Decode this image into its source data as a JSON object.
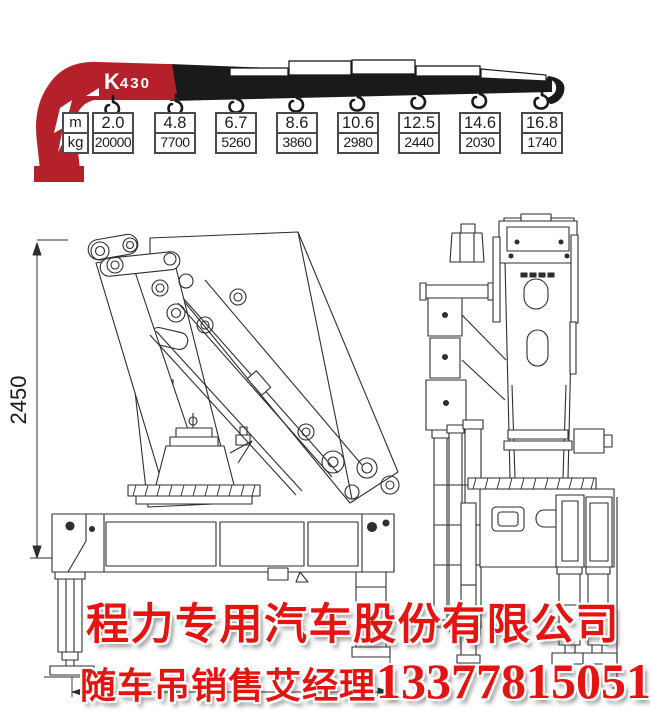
{
  "header": {
    "logo_k": "K",
    "logo_num": "430",
    "row_labels": {
      "top": "m",
      "bottom": "kg"
    },
    "columns": [
      {
        "m": "2.0",
        "kg": "20000"
      },
      {
        "m": "4.8",
        "kg": "7700"
      },
      {
        "m": "6.7",
        "kg": "5260"
      },
      {
        "m": "8.6",
        "kg": "3860"
      },
      {
        "m": "10.6",
        "kg": "2980"
      },
      {
        "m": "12.5",
        "kg": "2440"
      },
      {
        "m": "14.6",
        "kg": "2030"
      },
      {
        "m": "16.8",
        "kg": "1740"
      }
    ]
  },
  "chart_data": {
    "type": "table",
    "title": "K430 crane load chart",
    "row_labels": [
      "m",
      "kg"
    ],
    "reach_m": [
      2.0,
      4.8,
      6.7,
      8.6,
      10.6,
      12.5,
      14.6,
      16.8
    ],
    "capacity_kg": [
      20000,
      7700,
      5260,
      3860,
      2980,
      2440,
      2030,
      1740
    ]
  },
  "side_view": {
    "height_dim": "2450"
  },
  "footer": {
    "company": "程力专用汽车股份有限公司",
    "sales_text": "随车吊销售艾经理",
    "phone": "13377815051"
  },
  "colors": {
    "brand_red": "#b5212b",
    "boom_black": "#1a1a1a",
    "text_red": "#e41410"
  }
}
